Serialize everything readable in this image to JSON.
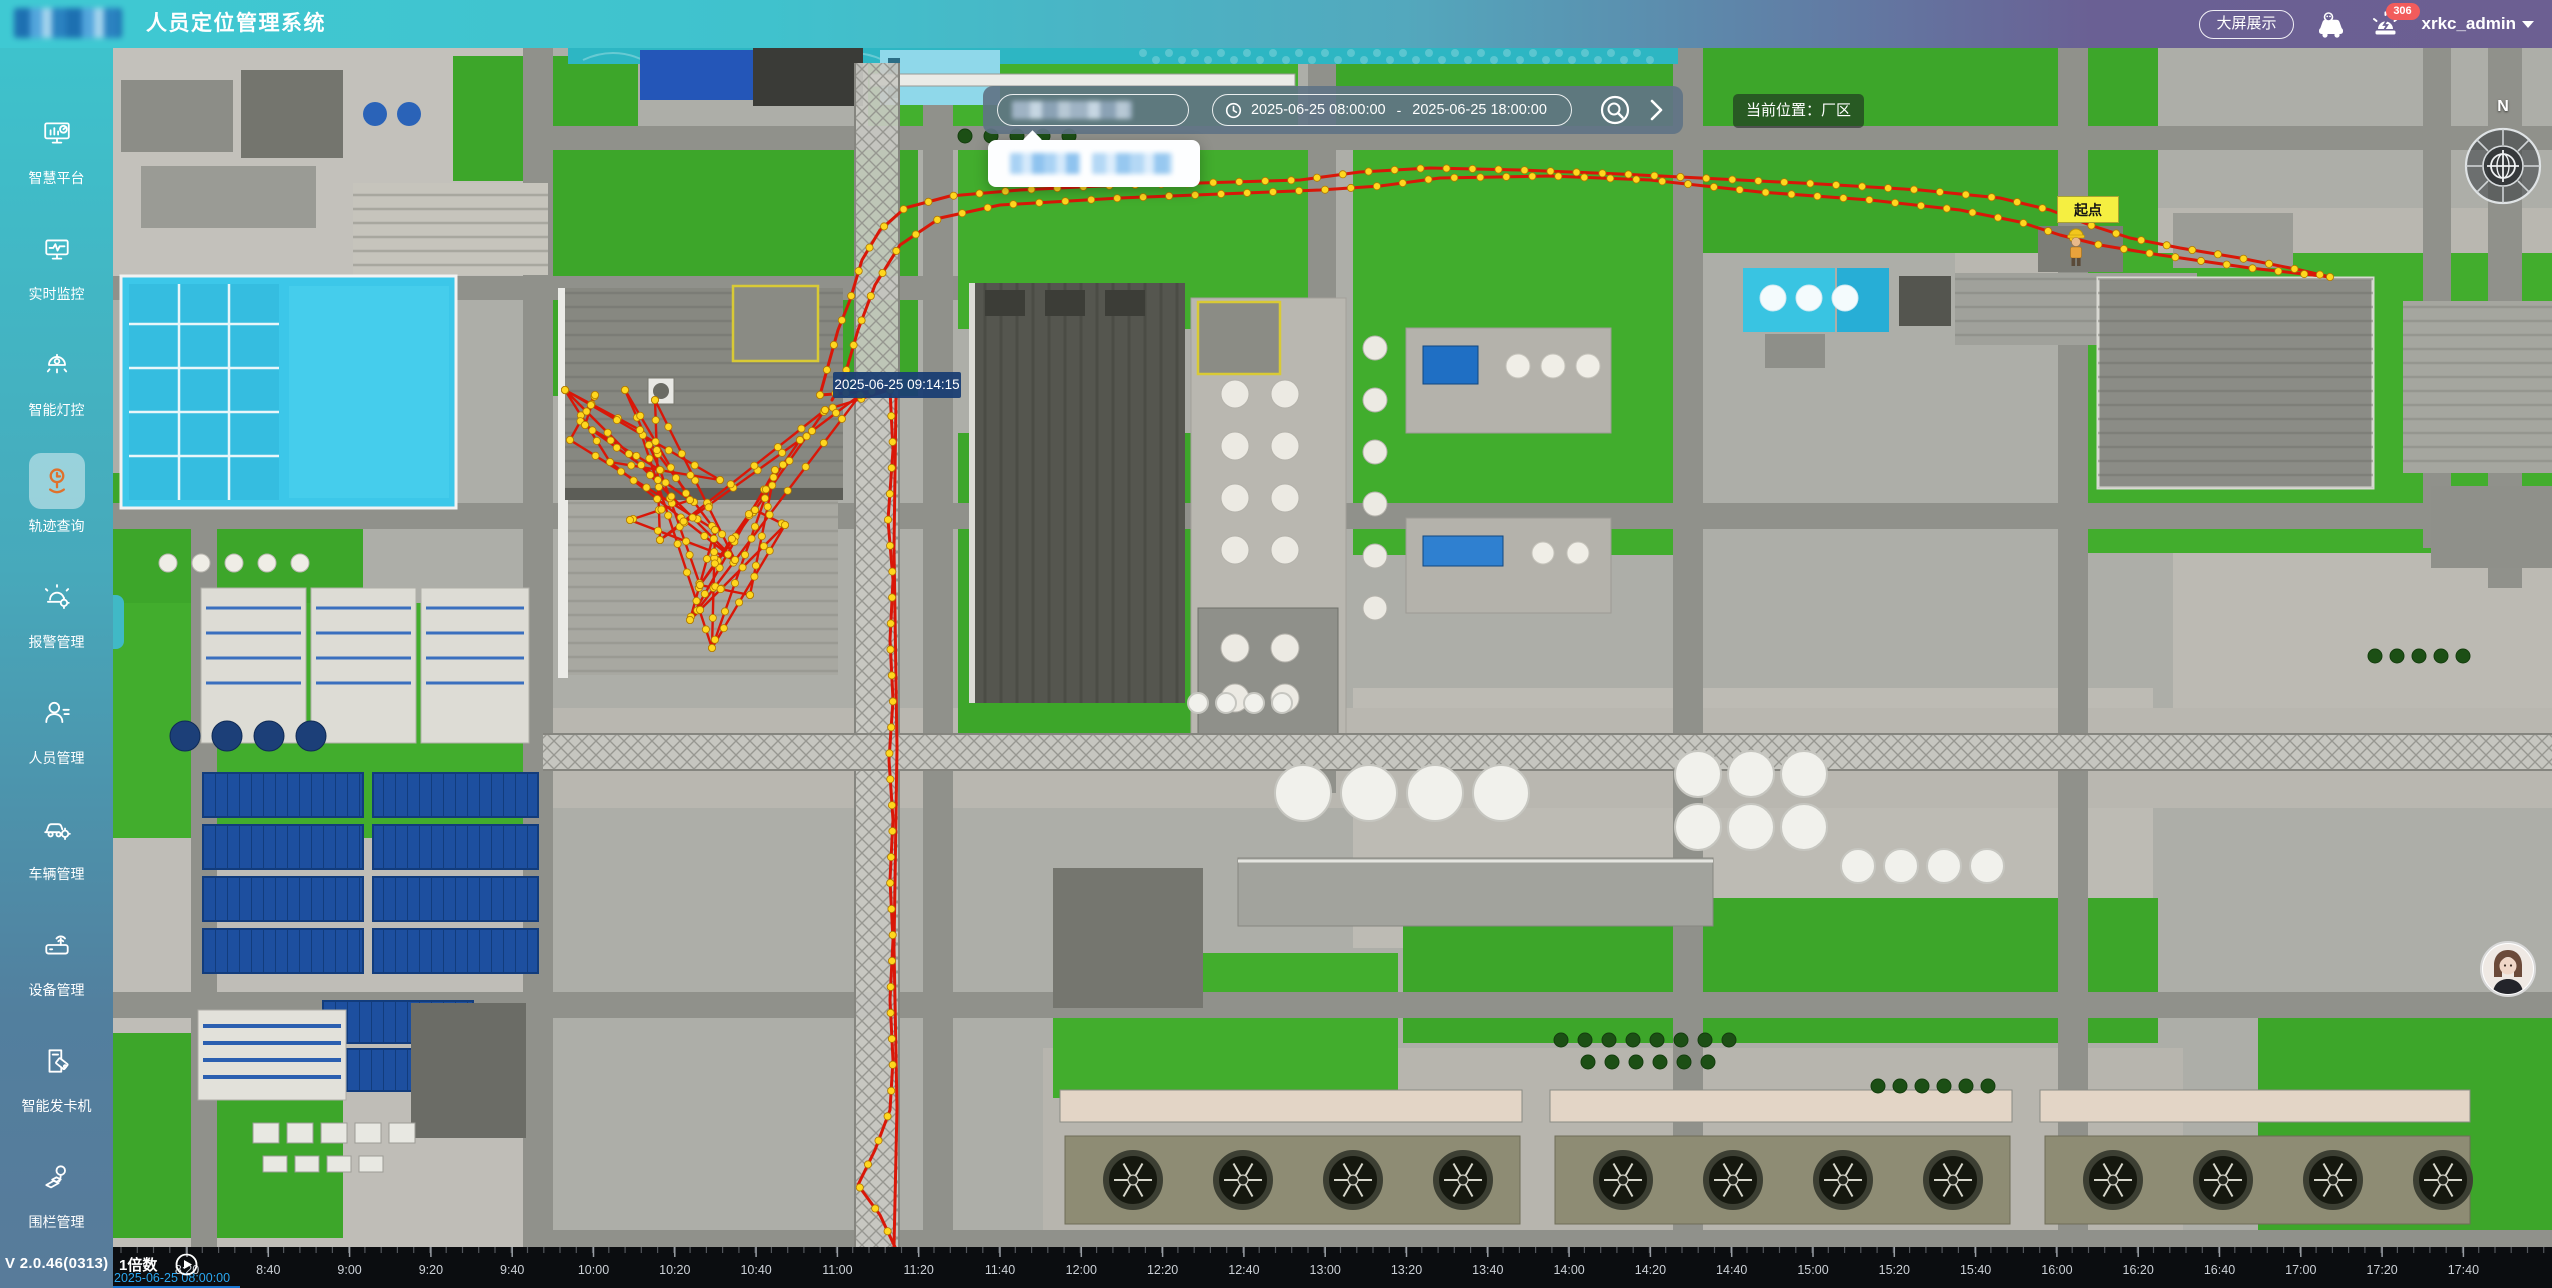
{
  "header": {
    "title": "人员定位管理系统",
    "big_screen_button": "大屏展示",
    "alarm_badge_count": "306",
    "username": "xrkc_admin"
  },
  "sidebar": {
    "items": [
      {
        "label": "智慧平台"
      },
      {
        "label": "实时监控"
      },
      {
        "label": "智能灯控"
      },
      {
        "label": "轨迹查询"
      },
      {
        "label": "报警管理"
      },
      {
        "label": "人员管理"
      },
      {
        "label": "车辆管理"
      },
      {
        "label": "设备管理"
      },
      {
        "label": "智能发卡机"
      },
      {
        "label": "围栏管理"
      }
    ],
    "active_index": 3,
    "version": "V 2.0.46(0313)"
  },
  "toolbar": {
    "date_start": "2025-06-25 08:00:00",
    "date_separator": "-",
    "date_end": "2025-06-25 18:00:00",
    "location_label": "当前位置：厂区"
  },
  "map": {
    "tooltip_time": "2025-06-25 09:14:15",
    "start_point_label": "起点",
    "compass_label": "N",
    "trajectory": {
      "color": "#d91708",
      "dot_color": "#ffd71e",
      "paths": [
        {
          "dots": true,
          "pts": [
            [
              707,
              347
            ],
            [
              725,
              282
            ],
            [
              737,
              252
            ],
            [
              749,
              212
            ],
            [
              767,
              182
            ],
            [
              792,
              160
            ],
            [
              837,
              148
            ],
            [
              907,
              142
            ],
            [
              987,
              138
            ],
            [
              1087,
              135
            ],
            [
              1187,
              132
            ],
            [
              1247,
              124
            ],
            [
              1317,
              120
            ],
            [
              1407,
              122
            ],
            [
              1507,
              126
            ],
            [
              1607,
              131
            ],
            [
              1707,
              136
            ],
            [
              1807,
              142
            ],
            [
              1887,
              150
            ],
            [
              1937,
              162
            ],
            [
              1977,
              177
            ],
            [
              2017,
              190
            ],
            [
              2067,
              200
            ],
            [
              2127,
              210
            ],
            [
              2187,
              222
            ],
            [
              2217,
              229
            ]
          ]
        },
        {
          "dots": true,
          "pts": [
            [
              2217,
              229
            ],
            [
              2137,
              220
            ],
            [
              2047,
              207
            ],
            [
              1987,
              197
            ],
            [
              1947,
              187
            ],
            [
              1907,
              174
            ],
            [
              1847,
              162
            ],
            [
              1757,
              152
            ],
            [
              1647,
              144
            ],
            [
              1537,
              132
            ],
            [
              1437,
              128
            ],
            [
              1327,
              130
            ],
            [
              1267,
              138
            ],
            [
              1207,
              142
            ],
            [
              1107,
              146
            ],
            [
              1007,
              150
            ],
            [
              887,
              157
            ],
            [
              827,
              170
            ],
            [
              787,
              197
            ],
            [
              762,
              237
            ],
            [
              745,
              282
            ],
            [
              732,
              327
            ],
            [
              719,
              352
            ]
          ]
        },
        {
          "dots": true,
          "pts": [
            [
              777,
              342
            ],
            [
              780,
              402
            ],
            [
              775,
              472
            ],
            [
              780,
              532
            ],
            [
              777,
              592
            ],
            [
              780,
              652
            ],
            [
              776,
              712
            ],
            [
              780,
              772
            ],
            [
              777,
              832
            ],
            [
              780,
              892
            ],
            [
              777,
              952
            ],
            [
              780,
              1012
            ],
            [
              777,
              1062
            ],
            [
              762,
              1102
            ],
            [
              745,
              1137
            ],
            [
              767,
              1167
            ],
            [
              782,
              1199
            ]
          ]
        },
        {
          "dots": false,
          "pts": [
            [
              781,
              1199
            ],
            [
              784,
              1060
            ],
            [
              781,
              900
            ],
            [
              784,
              700
            ],
            [
              781,
              500
            ],
            [
              783,
              350
            ]
          ]
        },
        {
          "dots": true,
          "pts": [
            [
              707,
              347
            ],
            [
              777,
              342
            ]
          ]
        }
      ],
      "cluster": {
        "nodes": [
          [
            452,
            342
          ],
          [
            472,
            377
          ],
          [
            457,
            392
          ],
          [
            497,
            414
          ],
          [
            527,
            382
          ],
          [
            547,
            422
          ],
          [
            577,
            452
          ],
          [
            602,
            482
          ],
          [
            622,
            512
          ],
          [
            587,
            537
          ],
          [
            577,
            572
          ],
          [
            599,
            600
          ],
          [
            547,
            492
          ],
          [
            517,
            472
          ],
          [
            642,
            462
          ],
          [
            662,
            422
          ],
          [
            687,
            392
          ],
          [
            712,
            362
          ],
          [
            747,
            347
          ],
          [
            777,
            342
          ],
          [
            482,
            347
          ],
          [
            512,
            342
          ],
          [
            542,
            352
          ],
          [
            672,
            477
          ],
          [
            637,
            547
          ],
          [
            607,
            432
          ]
        ],
        "edges": [
          [
            0,
            4
          ],
          [
            0,
            3
          ],
          [
            1,
            5
          ],
          [
            2,
            7
          ],
          [
            3,
            8
          ],
          [
            4,
            7
          ],
          [
            4,
            11
          ],
          [
            5,
            9
          ],
          [
            6,
            1
          ],
          [
            7,
            10
          ],
          [
            8,
            0
          ],
          [
            9,
            14
          ],
          [
            10,
            15
          ],
          [
            11,
            7
          ],
          [
            12,
            16
          ],
          [
            13,
            8
          ],
          [
            14,
            17
          ],
          [
            15,
            11
          ],
          [
            16,
            9
          ],
          [
            17,
            12
          ],
          [
            18,
            10
          ],
          [
            19,
            17
          ],
          [
            20,
            2
          ],
          [
            21,
            5
          ],
          [
            22,
            8
          ],
          [
            23,
            10
          ],
          [
            24,
            15
          ],
          [
            25,
            3
          ],
          [
            19,
            18
          ],
          [
            18,
            16
          ],
          [
            0,
            25
          ],
          [
            24,
            9
          ],
          [
            23,
            11
          ],
          [
            12,
            22
          ],
          [
            6,
            13
          ],
          [
            1,
            20
          ],
          [
            21,
            6
          ],
          [
            14,
            23
          ]
        ]
      }
    }
  },
  "timeline": {
    "speed_label": "1倍数",
    "current_time": "2025-06-25 08:00:00",
    "start_x": 74,
    "step": 81.3,
    "ticks": [
      "8:20",
      "8:40",
      "9:00",
      "9:20",
      "9:40",
      "10:00",
      "10:20",
      "10:40",
      "11:00",
      "11:20",
      "11:40",
      "12:00",
      "12:20",
      "12:40",
      "13:00",
      "13:20",
      "13:40",
      "14:00",
      "14:20",
      "14:40",
      "15:00",
      "15:20",
      "15:40",
      "16:00",
      "16:20",
      "16:40",
      "17:00",
      "17:20",
      "17:40"
    ]
  }
}
